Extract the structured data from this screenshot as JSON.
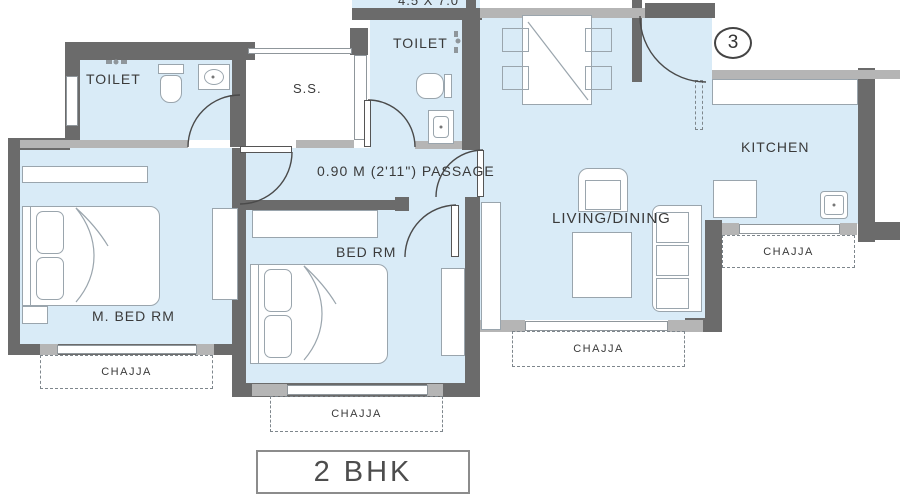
{
  "plan": {
    "unit_type": "2 BHK",
    "unit_number": "3",
    "dimension": "4.5 X 7.0",
    "labels": {
      "toilet_1": "TOILET",
      "toilet_2": "TOILET",
      "store": "S.S.",
      "kitchen": "KITCHEN",
      "living": "LIVING/DINING",
      "passage": "0.90 M (2'11\") PASSAGE",
      "bedroom": "BED RM",
      "master_bedroom": "M. BED RM"
    },
    "chajjas": [
      "CHAJJA",
      "CHAJJA",
      "CHAJJA",
      "CHAJJA"
    ],
    "colors": {
      "room_fill": "#d9ebf7",
      "wall_dark": "#6b6b6b",
      "wall_light": "#b5b5b5",
      "outline": "#8f969b",
      "text": "#3a3a3a"
    }
  }
}
